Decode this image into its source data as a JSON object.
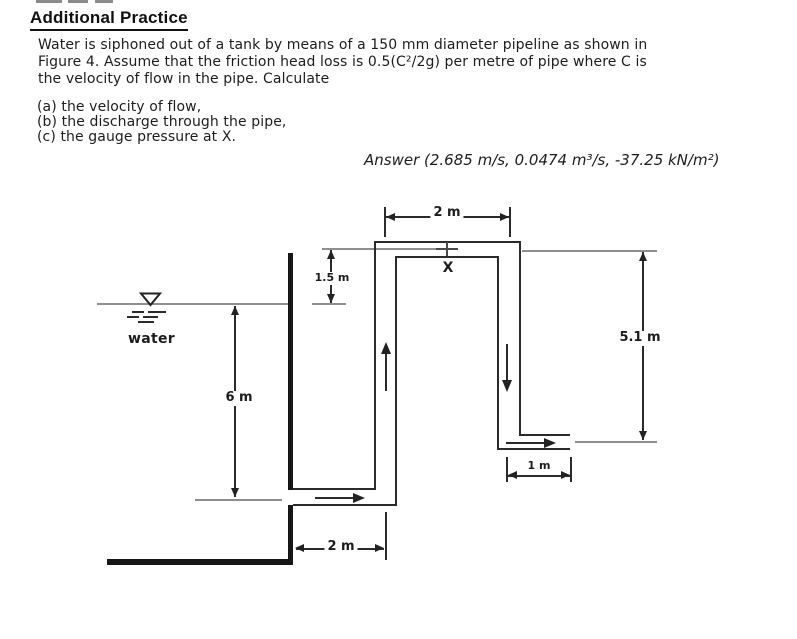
{
  "header": {
    "title": "Additional Practice"
  },
  "problem": {
    "line1": "Water is siphoned out of a tank by means of a 150 mm diameter pipeline as shown in",
    "line2": "Figure 4. Assume that the friction head loss is 0.5(C²/2g) per metre of pipe where C is",
    "line3": "the velocity of flow in the pipe. Calculate",
    "items": [
      "(a) the velocity of flow,",
      "(b) the discharge through the pipe,",
      "(c) the gauge pressure at X."
    ],
    "answer": "Answer (2.685 m/s, 0.0474 m³/s, -37.25 kN/m²)"
  },
  "figure": {
    "dim_top_span": "2 m",
    "dim_riser_above_water": "1.5 m",
    "dim_water_depth": "6 m",
    "dim_right_drop": "5.1 m",
    "dim_outlet_length": "1 m",
    "dim_tank_to_riser": "2 m",
    "water_label": "water",
    "point_label": "X"
  },
  "colors": {
    "ink": "#222222",
    "grey_line": "#8f8f8f",
    "background": "#ffffff"
  }
}
